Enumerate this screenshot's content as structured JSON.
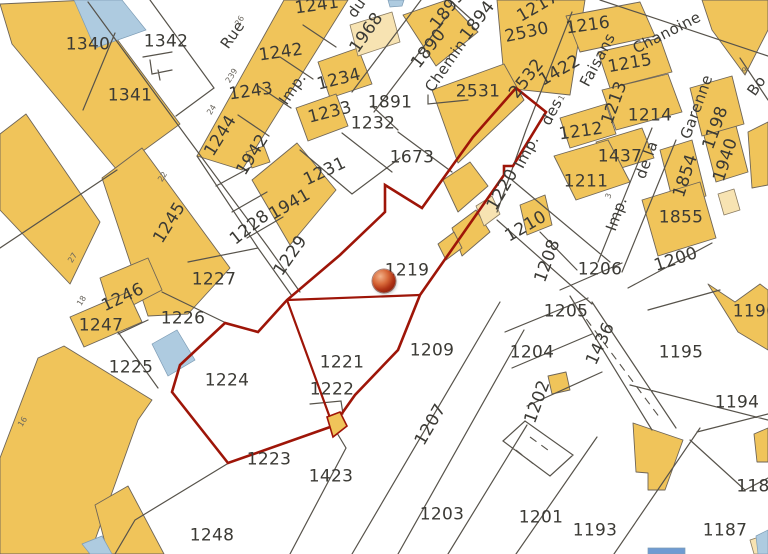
{
  "map": {
    "selected_parcel": "1219",
    "colors": {
      "background": "#FFFFFF",
      "building": "#F0C45A",
      "building_light": "#F7E3B2",
      "water": "#AECBE0",
      "water_strong": "#6F9BD2",
      "parcel_line": "#57534B",
      "selection_outline": "#9E1508",
      "parcel_label": "#3B3A35",
      "street_label": "#3C3B37",
      "tiny_label": "#6A665E"
    },
    "marker": {
      "label": "location-marker",
      "x": 384,
      "y": 281
    },
    "parcel_labels": [
      {
        "t": "1340",
        "x": 88,
        "y": 45,
        "r": 0
      },
      {
        "t": "1342",
        "x": 166,
        "y": 42,
        "r": 0
      },
      {
        "t": "1341",
        "x": 130,
        "y": 96,
        "r": 0
      },
      {
        "t": "1242",
        "x": 281,
        "y": 53,
        "r": -8
      },
      {
        "t": "1241",
        "x": 317,
        "y": 6,
        "r": -8
      },
      {
        "t": "1243",
        "x": 251,
        "y": 92,
        "r": -8
      },
      {
        "t": "1244",
        "x": 221,
        "y": 136,
        "r": -58
      },
      {
        "t": "1245",
        "x": 170,
        "y": 223,
        "r": -58
      },
      {
        "t": "1246",
        "x": 123,
        "y": 298,
        "r": -25
      },
      {
        "t": "1247",
        "x": 101,
        "y": 326,
        "r": 0
      },
      {
        "t": "1225",
        "x": 131,
        "y": 368,
        "r": 0
      },
      {
        "t": "1224",
        "x": 227,
        "y": 381,
        "r": 0
      },
      {
        "t": "1226",
        "x": 183,
        "y": 319,
        "r": 0
      },
      {
        "t": "1227",
        "x": 214,
        "y": 280,
        "r": 0
      },
      {
        "t": "1228",
        "x": 250,
        "y": 228,
        "r": -38
      },
      {
        "t": "1229",
        "x": 291,
        "y": 256,
        "r": -55
      },
      {
        "t": "1942",
        "x": 253,
        "y": 155,
        "r": -58
      },
      {
        "t": "1941",
        "x": 290,
        "y": 205,
        "r": -30
      },
      {
        "t": "1231",
        "x": 325,
        "y": 172,
        "r": -25
      },
      {
        "t": "1233",
        "x": 330,
        "y": 113,
        "r": -14
      },
      {
        "t": "1234",
        "x": 339,
        "y": 80,
        "r": -14
      },
      {
        "t": "1232",
        "x": 373,
        "y": 124,
        "r": 0
      },
      {
        "t": "1891",
        "x": 390,
        "y": 103,
        "r": 0
      },
      {
        "t": "1968",
        "x": 367,
        "y": 33,
        "r": -55
      },
      {
        "t": "1890",
        "x": 429,
        "y": 49,
        "r": -52
      },
      {
        "t": "1894",
        "x": 478,
        "y": 21,
        "r": -52
      },
      {
        "t": "1895",
        "x": 448,
        "y": 10,
        "r": -52
      },
      {
        "t": "2530",
        "x": 527,
        "y": 33,
        "r": -12
      },
      {
        "t": "2531",
        "x": 478,
        "y": 92,
        "r": 0
      },
      {
        "t": "2532",
        "x": 527,
        "y": 79,
        "r": -52
      },
      {
        "t": "1217",
        "x": 538,
        "y": 7,
        "r": -30
      },
      {
        "t": "1216",
        "x": 588,
        "y": 26,
        "r": -8
      },
      {
        "t": "1422",
        "x": 560,
        "y": 71,
        "r": -30
      },
      {
        "t": "1215",
        "x": 630,
        "y": 64,
        "r": -10
      },
      {
        "t": "1213",
        "x": 615,
        "y": 103,
        "r": -70
      },
      {
        "t": "1214",
        "x": 650,
        "y": 116,
        "r": 0
      },
      {
        "t": "1212",
        "x": 581,
        "y": 132,
        "r": -8
      },
      {
        "t": "1211",
        "x": 586,
        "y": 182,
        "r": 0
      },
      {
        "t": "1437",
        "x": 620,
        "y": 157,
        "r": 0
      },
      {
        "t": "1854",
        "x": 686,
        "y": 176,
        "r": -72
      },
      {
        "t": "1940",
        "x": 726,
        "y": 160,
        "r": -72
      },
      {
        "t": "1198",
        "x": 716,
        "y": 128,
        "r": -70
      },
      {
        "t": "1855",
        "x": 681,
        "y": 218,
        "r": 0
      },
      {
        "t": "1200",
        "x": 676,
        "y": 260,
        "r": -18
      },
      {
        "t": "1206",
        "x": 600,
        "y": 270,
        "r": 0
      },
      {
        "t": "1208",
        "x": 548,
        "y": 261,
        "r": -70
      },
      {
        "t": "1210",
        "x": 526,
        "y": 227,
        "r": -30
      },
      {
        "t": "1220",
        "x": 503,
        "y": 190,
        "r": -60
      },
      {
        "t": "1673",
        "x": 412,
        "y": 158,
        "r": 0
      },
      {
        "t": "1219",
        "x": 407,
        "y": 271,
        "r": 0
      },
      {
        "t": "1209",
        "x": 432,
        "y": 351,
        "r": 0
      },
      {
        "t": "1221",
        "x": 342,
        "y": 363,
        "r": 0
      },
      {
        "t": "1222",
        "x": 332,
        "y": 390,
        "r": 0
      },
      {
        "t": "1205",
        "x": 566,
        "y": 312,
        "r": 0
      },
      {
        "t": "1204",
        "x": 532,
        "y": 353,
        "r": 0
      },
      {
        "t": "1202",
        "x": 538,
        "y": 402,
        "r": -70
      },
      {
        "t": "1436",
        "x": 601,
        "y": 344,
        "r": -65
      },
      {
        "t": "1195",
        "x": 681,
        "y": 353,
        "r": 0
      },
      {
        "t": "1196",
        "x": 755,
        "y": 312,
        "r": 0
      },
      {
        "t": "1194",
        "x": 737,
        "y": 403,
        "r": 0
      },
      {
        "t": "1207",
        "x": 431,
        "y": 425,
        "r": -60
      },
      {
        "t": "1423",
        "x": 331,
        "y": 477,
        "r": 0
      },
      {
        "t": "1223",
        "x": 269,
        "y": 460,
        "r": 0
      },
      {
        "t": "1248",
        "x": 212,
        "y": 536,
        "r": 0
      },
      {
        "t": "1203",
        "x": 442,
        "y": 515,
        "r": 0
      },
      {
        "t": "1201",
        "x": 541,
        "y": 518,
        "r": 0
      },
      {
        "t": "1193",
        "x": 595,
        "y": 531,
        "r": 0
      },
      {
        "t": "1187",
        "x": 725,
        "y": 531,
        "r": 0
      },
      {
        "t": "118",
        "x": 753,
        "y": 487,
        "r": 0
      }
    ],
    "street_labels": [
      {
        "t": "Rue",
        "x": 233,
        "y": 35,
        "r": -55
      },
      {
        "t": "du",
        "x": 357,
        "y": 8,
        "r": -55
      },
      {
        "t": "Imp.",
        "x": 293,
        "y": 89,
        "r": -55
      },
      {
        "t": "Chemin",
        "x": 446,
        "y": 66,
        "r": -55
      },
      {
        "t": "Chanoine",
        "x": 667,
        "y": 33,
        "r": -27
      },
      {
        "t": "Bo",
        "x": 757,
        "y": 86,
        "r": -55
      },
      {
        "t": "Imp.",
        "x": 527,
        "y": 152,
        "r": -62
      },
      {
        "t": "des",
        "x": 552,
        "y": 112,
        "r": -62
      },
      {
        "t": "Faisans",
        "x": 598,
        "y": 60,
        "r": -62
      },
      {
        "t": "Imp.",
        "x": 617,
        "y": 214,
        "r": -70
      },
      {
        "t": "de la",
        "x": 647,
        "y": 160,
        "r": -70
      },
      {
        "t": "Garenne",
        "x": 697,
        "y": 107,
        "r": -70
      }
    ],
    "tiny_labels": [
      {
        "t": "26",
        "x": 240,
        "y": 21,
        "r": -58
      },
      {
        "t": "239",
        "x": 232,
        "y": 76,
        "r": -58
      },
      {
        "t": "24",
        "x": 212,
        "y": 110,
        "r": -58
      },
      {
        "t": "22",
        "x": 163,
        "y": 177,
        "r": -58
      },
      {
        "t": "27",
        "x": 73,
        "y": 258,
        "r": -58
      },
      {
        "t": "18",
        "x": 82,
        "y": 301,
        "r": -58
      },
      {
        "t": "16",
        "x": 23,
        "y": 422,
        "r": -58
      },
      {
        "t": "1",
        "x": 562,
        "y": 98,
        "r": -62
      },
      {
        "t": "3",
        "x": 609,
        "y": 196,
        "r": -70
      },
      {
        "t": "9",
        "x": 745,
        "y": 71,
        "r": -30
      }
    ]
  }
}
